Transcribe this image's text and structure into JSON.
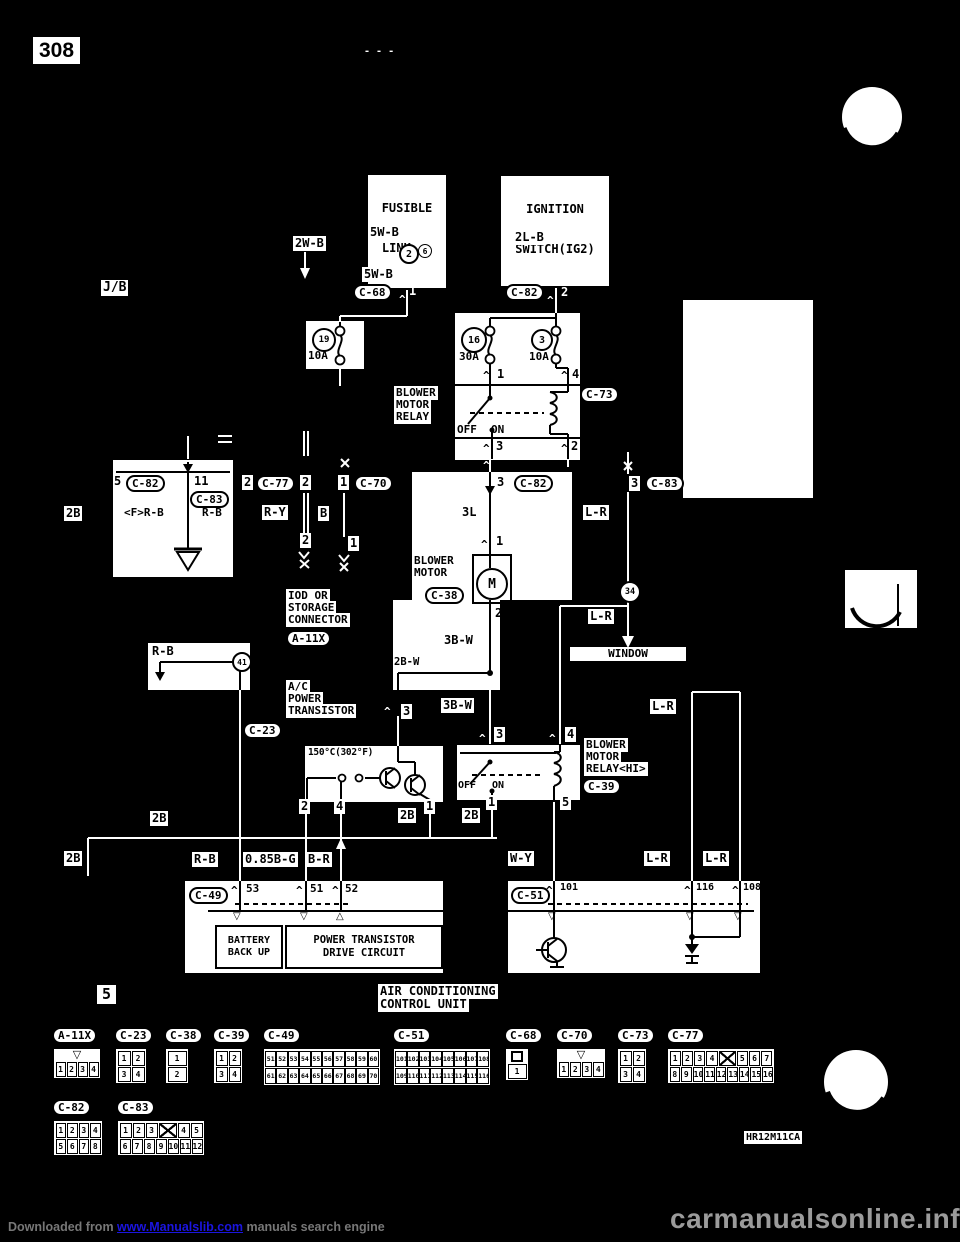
{
  "page": {
    "number": "308",
    "dashes": "- - -",
    "doc_code": "HR12M11CA",
    "section_num": "5"
  },
  "colors": {
    "background": "#000000",
    "paper": "#ffffff",
    "ink": "#000000",
    "link_blue": "#1b15e0",
    "watermark_gray": "#8a8a8a"
  },
  "icons": {
    "pin_chevron": "^",
    "triangle_down": "▽",
    "triangle_up": "△",
    "cross_mark": "×"
  },
  "supply": {
    "fusible_link_line1": "FUSIBLE",
    "fusible_link_line2": "LINK",
    "fusible_link_no": "6",
    "ignition_line1": "IGNITION",
    "ignition_line2": "SWITCH(IG2)",
    "wire_5wb_upper": "5W-B",
    "node_joint2": "2",
    "wire_2wb": "2W-B",
    "wire_5wb_lower": "5W-B",
    "junction_block": "J/B",
    "c68_label": "C-68",
    "c68_pin": "1",
    "wire_2lb": "2L-B",
    "c82_label": "C-82",
    "c82_pin": "2",
    "fuse19_no": "19",
    "fuse19_amp": "10A",
    "fuse16_no": "16",
    "fuse16_amp": "30A",
    "fuse3_no": "3",
    "fuse3_amp": "10A"
  },
  "relay": {
    "name_l1": "BLOWER",
    "name_l2": "MOTOR",
    "name_l3": "RELAY",
    "pin_in1": "1",
    "pin_in4": "4",
    "c73_label": "C-73",
    "off": "OFF",
    "on": "ON",
    "pin_out3": "3",
    "pin_out2": "2"
  },
  "ground_branch": {
    "pin5": "5",
    "c82_label": "C-82",
    "pin11": "11",
    "c83_label": "C-83",
    "wire_frb": "<F>R-B",
    "wire_rb": "R-B",
    "ground": "E",
    "wire_2b": "2B"
  },
  "iod": {
    "pin2a": "2",
    "c77_label": "C-77",
    "pin2b": "2",
    "pin1a": "1",
    "c70_label": "C-70",
    "wire_ry": "R-Y",
    "wire_b": "B",
    "pin2": "2",
    "pin1": "1",
    "name_l1": "IOD OR",
    "name_l2": "STORAGE",
    "name_l3": "CONNECTOR",
    "a11x_label": "A-11X"
  },
  "blower": {
    "pin3": "3",
    "c82_label": "C-82",
    "wire_3l": "3L",
    "pin1": "1",
    "name_l1": "BLOWER",
    "name_l2": "MOTOR",
    "motor": "M",
    "c38_label": "C-38",
    "pin2": "2",
    "wire_3bw": "3B-W",
    "wire_2bw": "2B-W"
  },
  "window_branch": {
    "pin3": "3",
    "c83_label": "C-83",
    "wire_lr1": "L-R",
    "node_joint34": "34",
    "wire_lr2": "L-R",
    "window": "WINDOW"
  },
  "splice": {
    "wire_rb": "R-B",
    "node_joint41": "41"
  },
  "power_transistor": {
    "name_l1": "A/C",
    "name_l2": "POWER",
    "name_l3": "TRANSISTOR",
    "pin3": "3",
    "c23_label": "C-23",
    "thermo": "150°C(302°F)",
    "pin2": "2",
    "pin4": "4",
    "pin1": "1",
    "wire_2b": "2B"
  },
  "relay_hi": {
    "wire_3bw": "3B-W",
    "wire_lr": "L-R",
    "pin3": "3",
    "pin4": "4",
    "off": "OFF",
    "on": "ON",
    "pin1": "1",
    "pin5": "5",
    "wire_2b": "2B",
    "name_l1": "BLOWER",
    "name_l2": "MOTOR",
    "name_l3": "RELAY<HI>",
    "c39_label": "C-39"
  },
  "bus_2b": {
    "label_left": "2B",
    "label_mid": "2B"
  },
  "control_unit": {
    "wire_rb": "R-B",
    "wire_085bg": "0.85B-G",
    "wire_br": "B-R",
    "c49_label": "C-49",
    "pin53": "53",
    "pin51": "51",
    "pin52": "52",
    "battery_l1": "BATTERY",
    "battery_l2": "BACK UP",
    "drive_l1": "POWER TRANSISTOR",
    "drive_l2": "DRIVE CIRCUIT",
    "wire_wy": "W-Y",
    "wire_lr1": "L-R",
    "wire_lr2": "L-R",
    "wire_lr3": "L-R",
    "c51_label": "C-51",
    "pin101": "101",
    "pin116": "116",
    "pin108": "108",
    "name_l1": "AIR CONDITIONING",
    "name_l2": "CONTROL UNIT"
  },
  "connectors_row1": [
    {
      "label": "A-11X",
      "notch": true,
      "rows": [
        [
          "1",
          "2",
          "3",
          "4"
        ]
      ]
    },
    {
      "label": "C-23",
      "rows": [
        [
          "1",
          "2"
        ],
        [
          "3",
          "4"
        ]
      ]
    },
    {
      "label": "C-38",
      "rows": [
        [
          "1"
        ],
        [
          "2"
        ]
      ]
    },
    {
      "label": "C-39",
      "rows": [
        [
          "1",
          "2"
        ],
        [
          "3",
          "4"
        ]
      ]
    },
    {
      "label": "C-49",
      "rows": [
        [
          "51",
          "52",
          "53",
          "54",
          "55",
          "56",
          "57",
          "58",
          "59",
          "60"
        ],
        [
          "61",
          "62",
          "63",
          "64",
          "65",
          "66",
          "67",
          "68",
          "69",
          "70"
        ]
      ]
    },
    {
      "label": "C-51",
      "rows": [
        [
          "101",
          "102",
          "103",
          "104",
          "105",
          "106",
          "107",
          "108"
        ],
        [
          "109",
          "110",
          "111",
          "112",
          "113",
          "114",
          "115",
          "116"
        ]
      ]
    },
    {
      "label": "C-68",
      "plug": true,
      "rows": [
        [
          "1"
        ]
      ]
    },
    {
      "label": "C-70",
      "notch": true,
      "rows": [
        [
          "1",
          "2",
          "3",
          "4"
        ]
      ]
    },
    {
      "label": "C-73",
      "rows": [
        [
          "1",
          "2"
        ],
        [
          "3",
          "4"
        ]
      ]
    },
    {
      "label": "C-77",
      "rows": [
        [
          "1",
          "2",
          "3",
          "4",
          "X",
          "5",
          "6",
          "7"
        ],
        [
          "8",
          "9",
          "10",
          "11",
          "12",
          "13",
          "14",
          "15",
          "16"
        ]
      ]
    }
  ],
  "connectors_row2": [
    {
      "label": "C-82",
      "rows": [
        [
          "1",
          "2",
          "3",
          "4"
        ],
        [
          "5",
          "6",
          "7",
          "8"
        ]
      ]
    },
    {
      "label": "C-83",
      "rows": [
        [
          "1",
          "2",
          "3",
          "X",
          "4",
          "5"
        ],
        [
          "6",
          "7",
          "8",
          "9",
          "10",
          "11",
          "12"
        ]
      ]
    }
  ],
  "watermark": {
    "downloaded_prefix": "Downloaded from ",
    "link": "www.Manualslib.com",
    "downloaded_suffix": " manuals search engine",
    "site": "carmanualsonline.info"
  }
}
